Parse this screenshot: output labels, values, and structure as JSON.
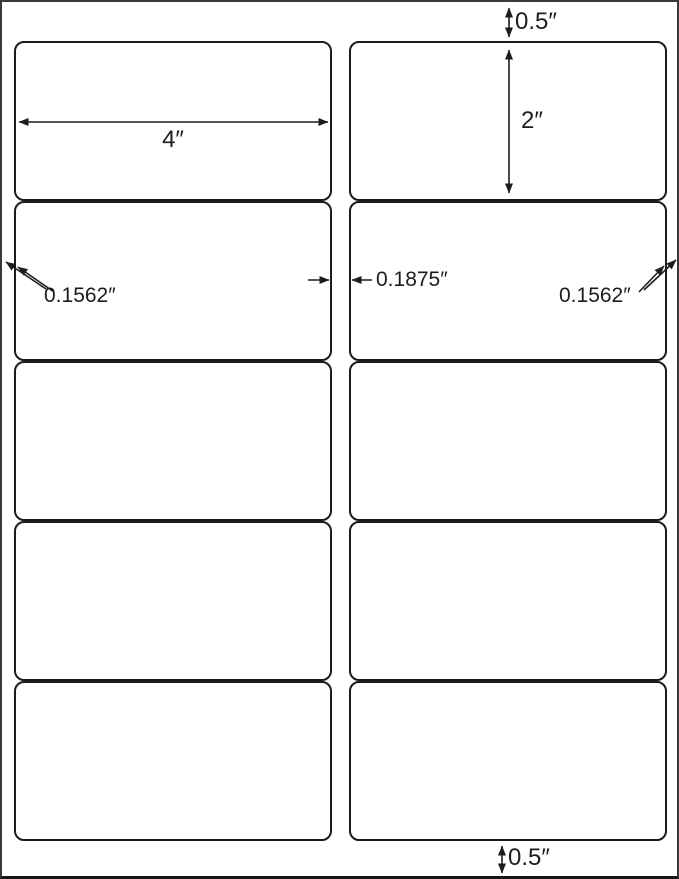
{
  "sheet": {
    "columns": 2,
    "rows": 5,
    "label_count": 10
  },
  "dimensions": {
    "top_margin": "0.5″",
    "label_width": "4″",
    "label_height": "2″",
    "left_margin": "0.1562″",
    "column_gap": "0.1875″",
    "right_margin": "0.1562″",
    "bottom_margin": "0.5″"
  }
}
